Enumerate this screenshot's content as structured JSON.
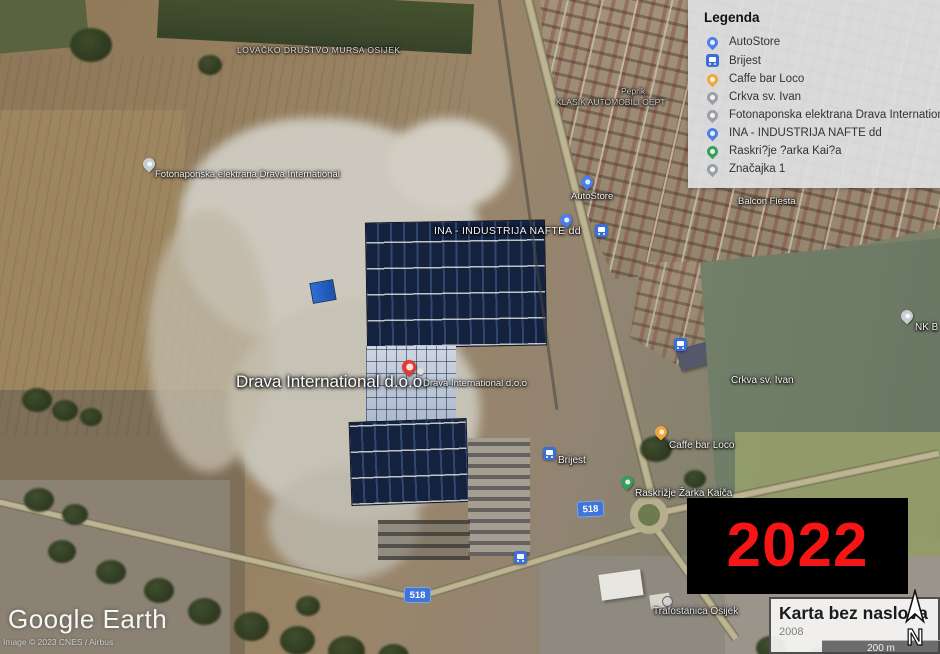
{
  "app": {
    "name": "Google Earth"
  },
  "logo": {
    "google": "Google",
    "earth": "Earth"
  },
  "copyright": "Image © 2023 CNES / Airbus",
  "legend": {
    "title": "Legenda",
    "items": [
      {
        "label": "AutoStore",
        "icon": "pin",
        "color": "#4d80e6"
      },
      {
        "label": "Brijest",
        "icon": "bus-square",
        "color": "#3a6fd8"
      },
      {
        "label": "Caffe bar Loco",
        "icon": "pin",
        "color": "#f0a73c"
      },
      {
        "label": "Crkva sv. Ivan",
        "icon": "pin",
        "color": "#9aa0a6"
      },
      {
        "label": "Fotonaponska elektrana Drava International",
        "icon": "pin",
        "color": "#9aa0a6"
      },
      {
        "label": "INA - INDUSTRIJA NAFTE dd",
        "icon": "pin",
        "color": "#4d80e6"
      },
      {
        "label": "Raskri?je ?arka Kai?a",
        "icon": "pin",
        "color": "#34a05a"
      },
      {
        "label": "Značajka 1",
        "icon": "pin",
        "color": "#9aa0a6"
      }
    ]
  },
  "year_overlay": {
    "text": "2022",
    "text_color": "#f51515",
    "bg_color": "#000000"
  },
  "title_box": {
    "title": "Karta bez naslova",
    "subtitle": "2008"
  },
  "scale_bar": {
    "label": "200 m"
  },
  "compass": {
    "label": "N"
  },
  "road_shields": {
    "a": "518",
    "b": "518"
  },
  "map_labels": {
    "lovacko": "LOVAČKO DRUŠTVO MURSA OSIJEK",
    "fotonaponska": "Fotonaponska elektrana Drava International",
    "klasik": "KLASIK AUTOMOBILI OEPT",
    "peprik": "Peprik",
    "balcon": "Balcon Fiesta",
    "ina": "INA - INDUSTRIJA NAFTE dd",
    "autostore": "AutoStore",
    "drava_large": "Drava International d.o.o.",
    "drava_pin": "Drava International d.o.o",
    "crkva": "Crkva sv. Ivan",
    "brijest": "Brijest",
    "caffe": "Caffe bar Loco",
    "raskrizje": "Raskrižje Žarka Kaiča",
    "nk": "NK B",
    "trafostanica": "Trafostanica Osijek"
  },
  "marker_colors": {
    "blue": "#4d80e6",
    "grey": "#c8cdd2",
    "yellow": "#f0a73c",
    "green": "#34a05a",
    "red": "#e03c31",
    "bus": "#3a6fd8"
  }
}
